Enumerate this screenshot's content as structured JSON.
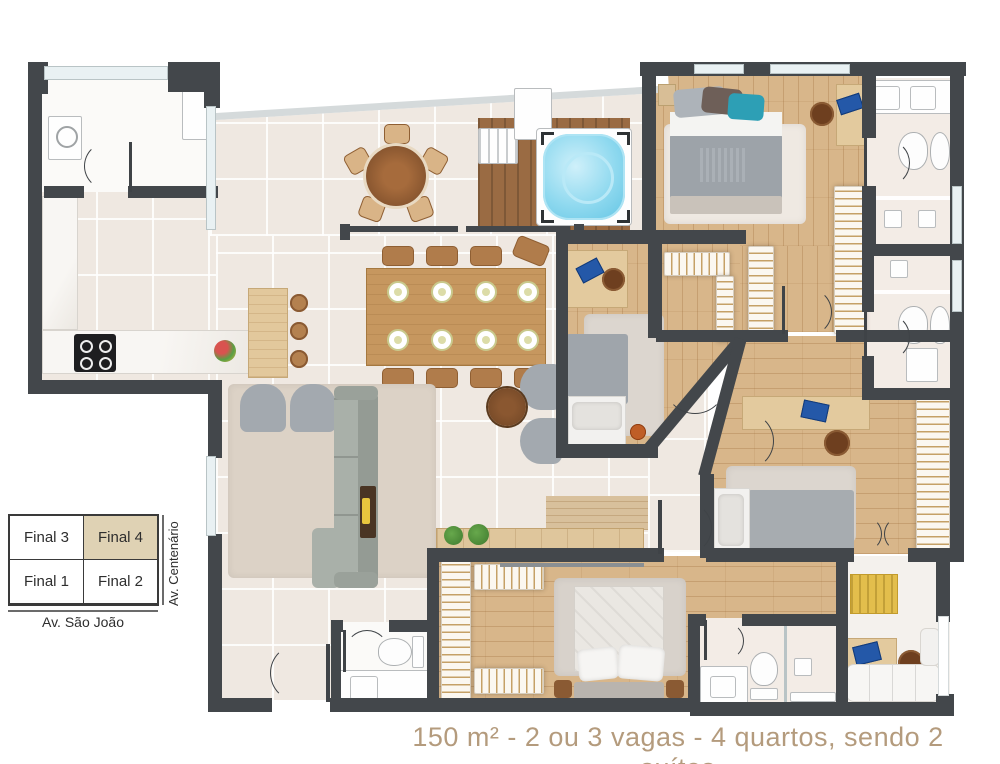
{
  "legend": {
    "cells": [
      {
        "label": "Final 3",
        "highlighted": false
      },
      {
        "label": "Final 4",
        "highlighted": true
      },
      {
        "label": "Final 1",
        "highlighted": false
      },
      {
        "label": "Final 2",
        "highlighted": false
      }
    ],
    "street_bottom": "Av. São João",
    "street_right": "Av. Centenário"
  },
  "caption": {
    "text": "150 m² - 2 ou 3 vagas - 4 quartos, sendo 2 suítes"
  },
  "unit": {
    "area_m2": "150 m²",
    "parking": "2 ou 3 vagas",
    "bedrooms": "4 quartos",
    "suites": "2 suítes",
    "selected_final": "Final 4"
  },
  "palette": {
    "wall": "#43474B",
    "tile_floor": "#EFE8E1",
    "wood_floor": "#D8B68A",
    "deck_wood": "#9A6B43",
    "spa_water": "#8FD9EF",
    "caption_text": "#B49B7D",
    "legend_highlight": "#DFD2B4",
    "rug": "#D9D3CC",
    "sofa": "#A3A9AF",
    "accent_yellow": "#E3BE4C",
    "laptop_blue": "#2458A8"
  }
}
